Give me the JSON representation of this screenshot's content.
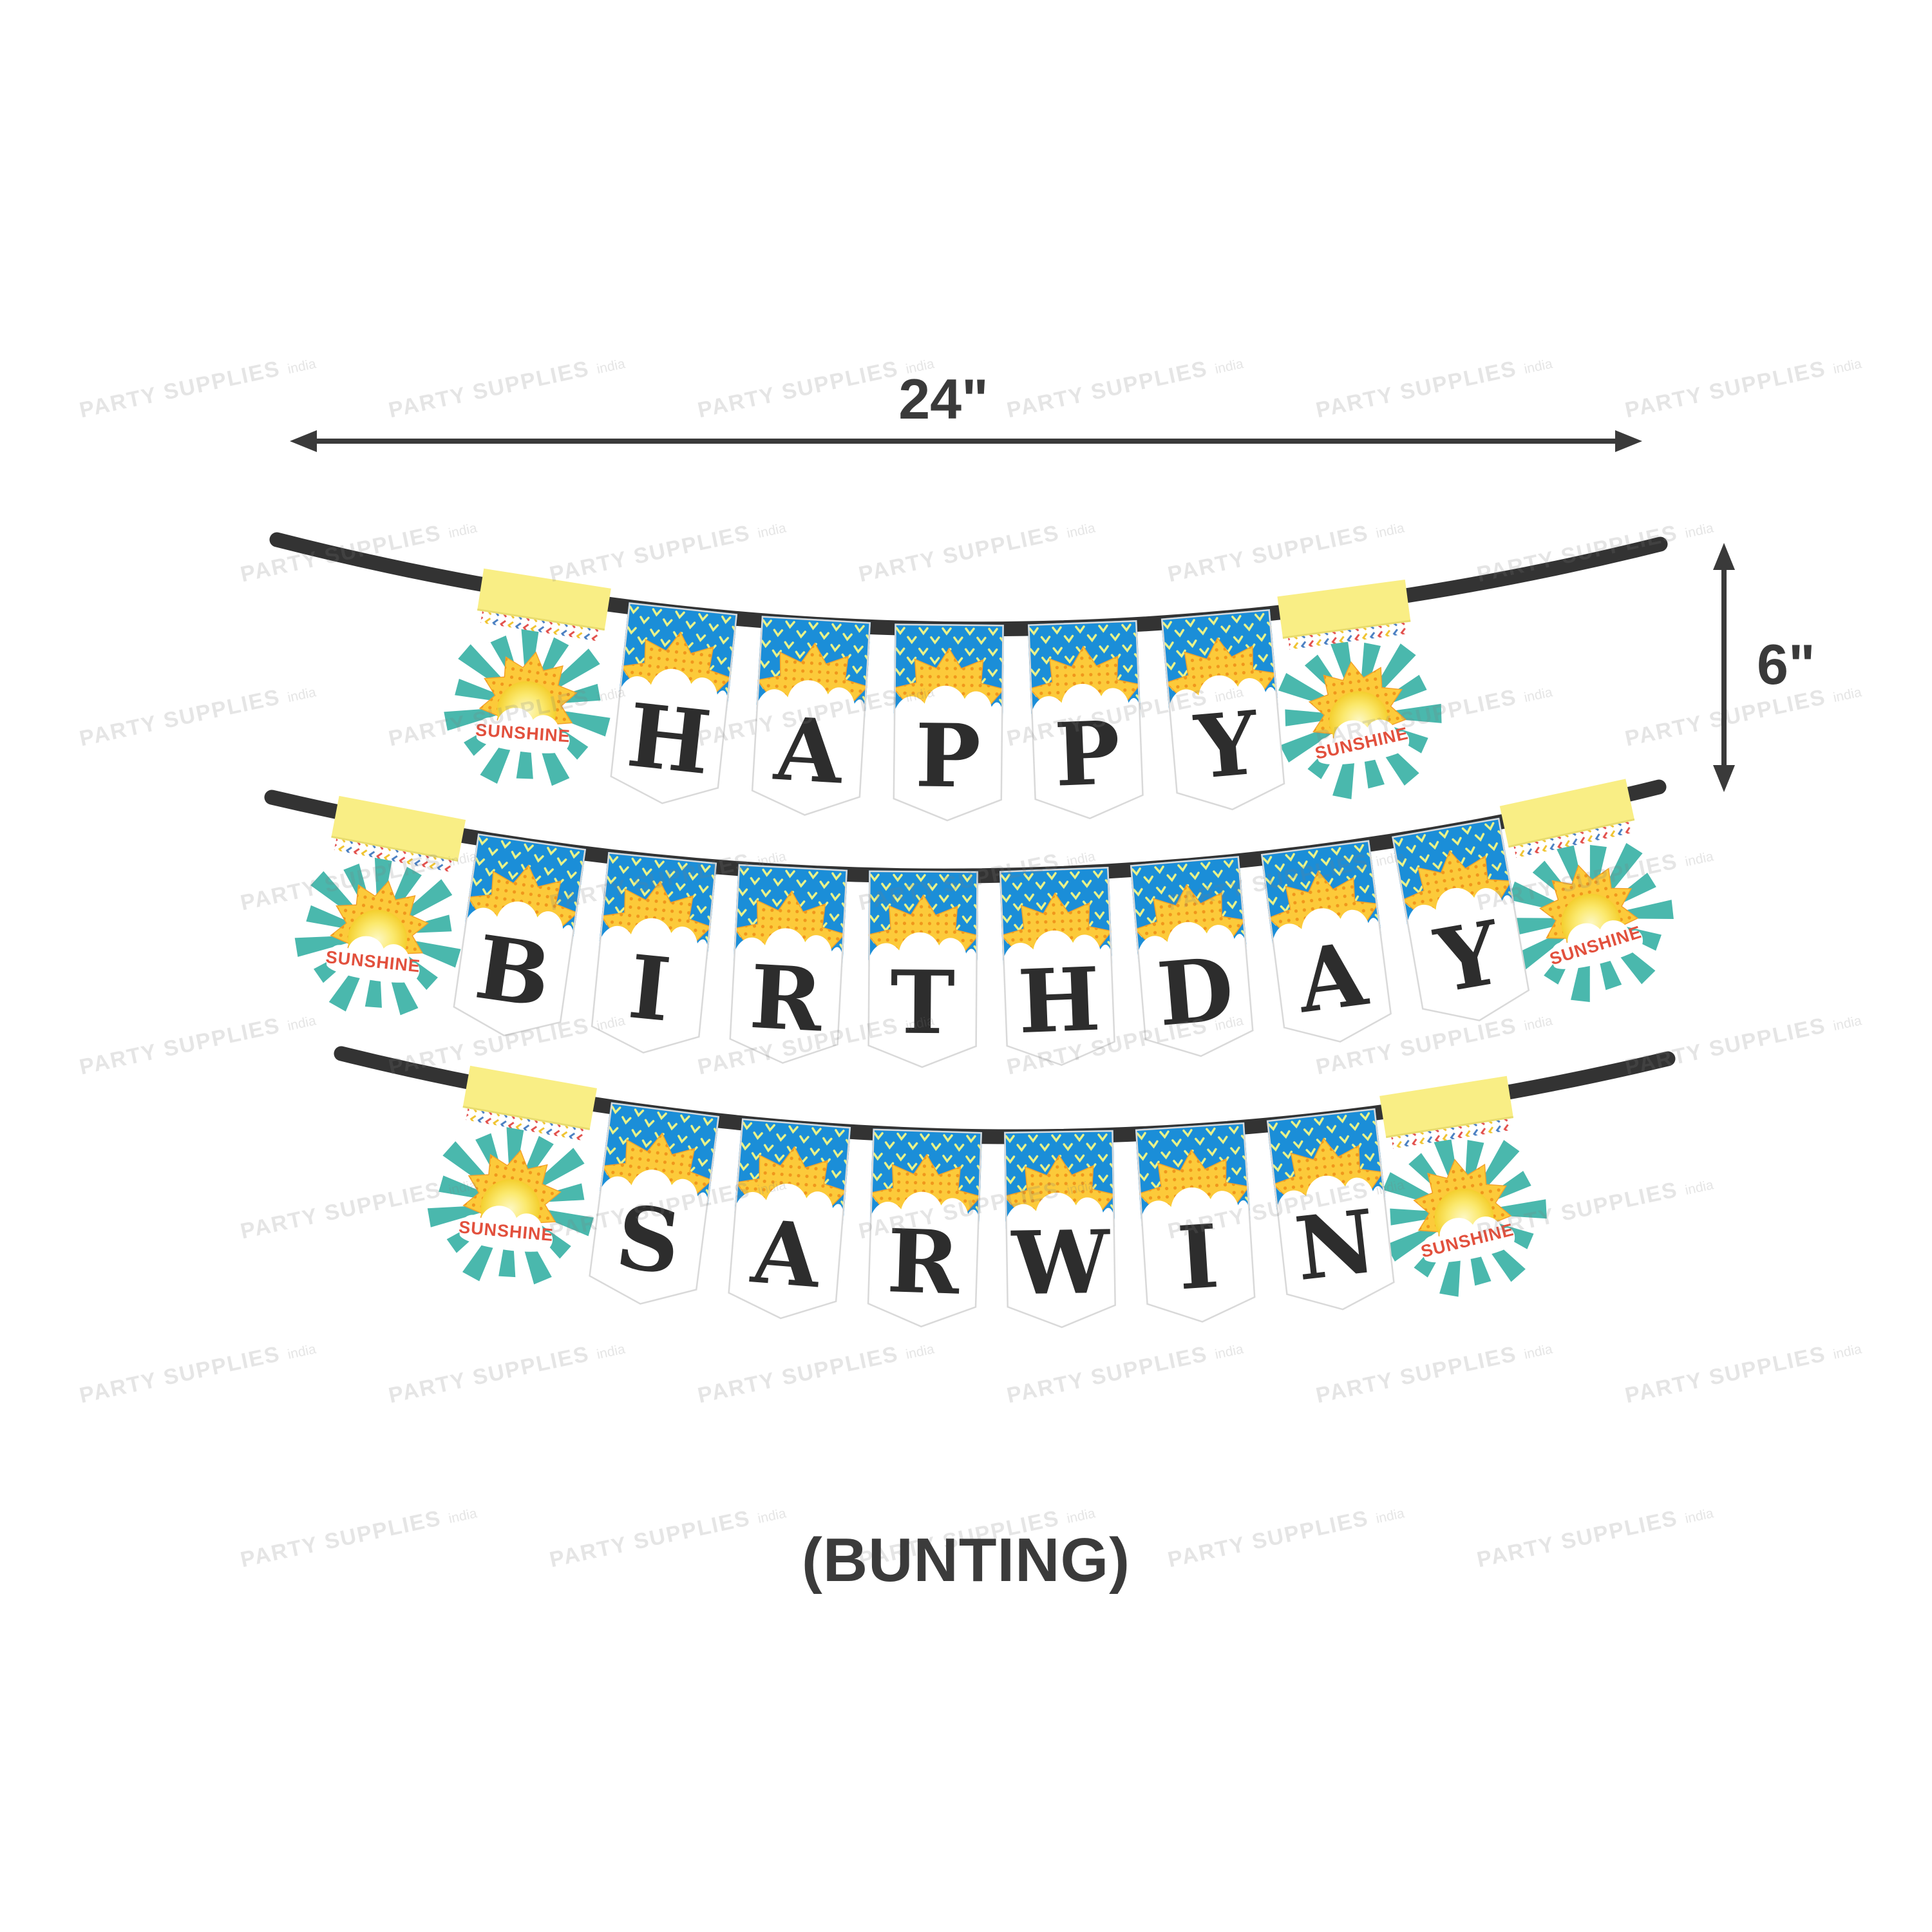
{
  "dimensions": {
    "width_label": "24\"",
    "height_label": "6\""
  },
  "caption": "(BUNTING)",
  "watermark": {
    "brand": "PARTY SUPPLIES",
    "region": "india"
  },
  "bunting": {
    "end_flag_text": "SUNSHINE",
    "rows": [
      {
        "name": "row-1",
        "word": "HAPPY"
      },
      {
        "name": "row-2",
        "word": "BIRTHDAY"
      },
      {
        "name": "row-3",
        "word": "SARWIN"
      }
    ]
  },
  "colors": {
    "flag_blue": "#1b8ed8",
    "chevron_yellow": "#eaf388",
    "sun_yellow": "#fcca3a",
    "sun_edge_orange": "#f4a22b",
    "sun_dot_orange": "#f0971c",
    "sun_core_light": "#fdf8c5",
    "band_yellow": "#f9ee85",
    "ray_teal": "#4ab8ad",
    "sunshine_red": "#e2503d",
    "letter_black": "#2d2d2d",
    "trim_red": "#e2504c",
    "trim_gold": "#f0c330",
    "trim_blue": "#4a7fc1",
    "string_dark": "#333333",
    "annotation_dark": "#3a3a3a",
    "flag_edge": "#d9d9d9"
  }
}
